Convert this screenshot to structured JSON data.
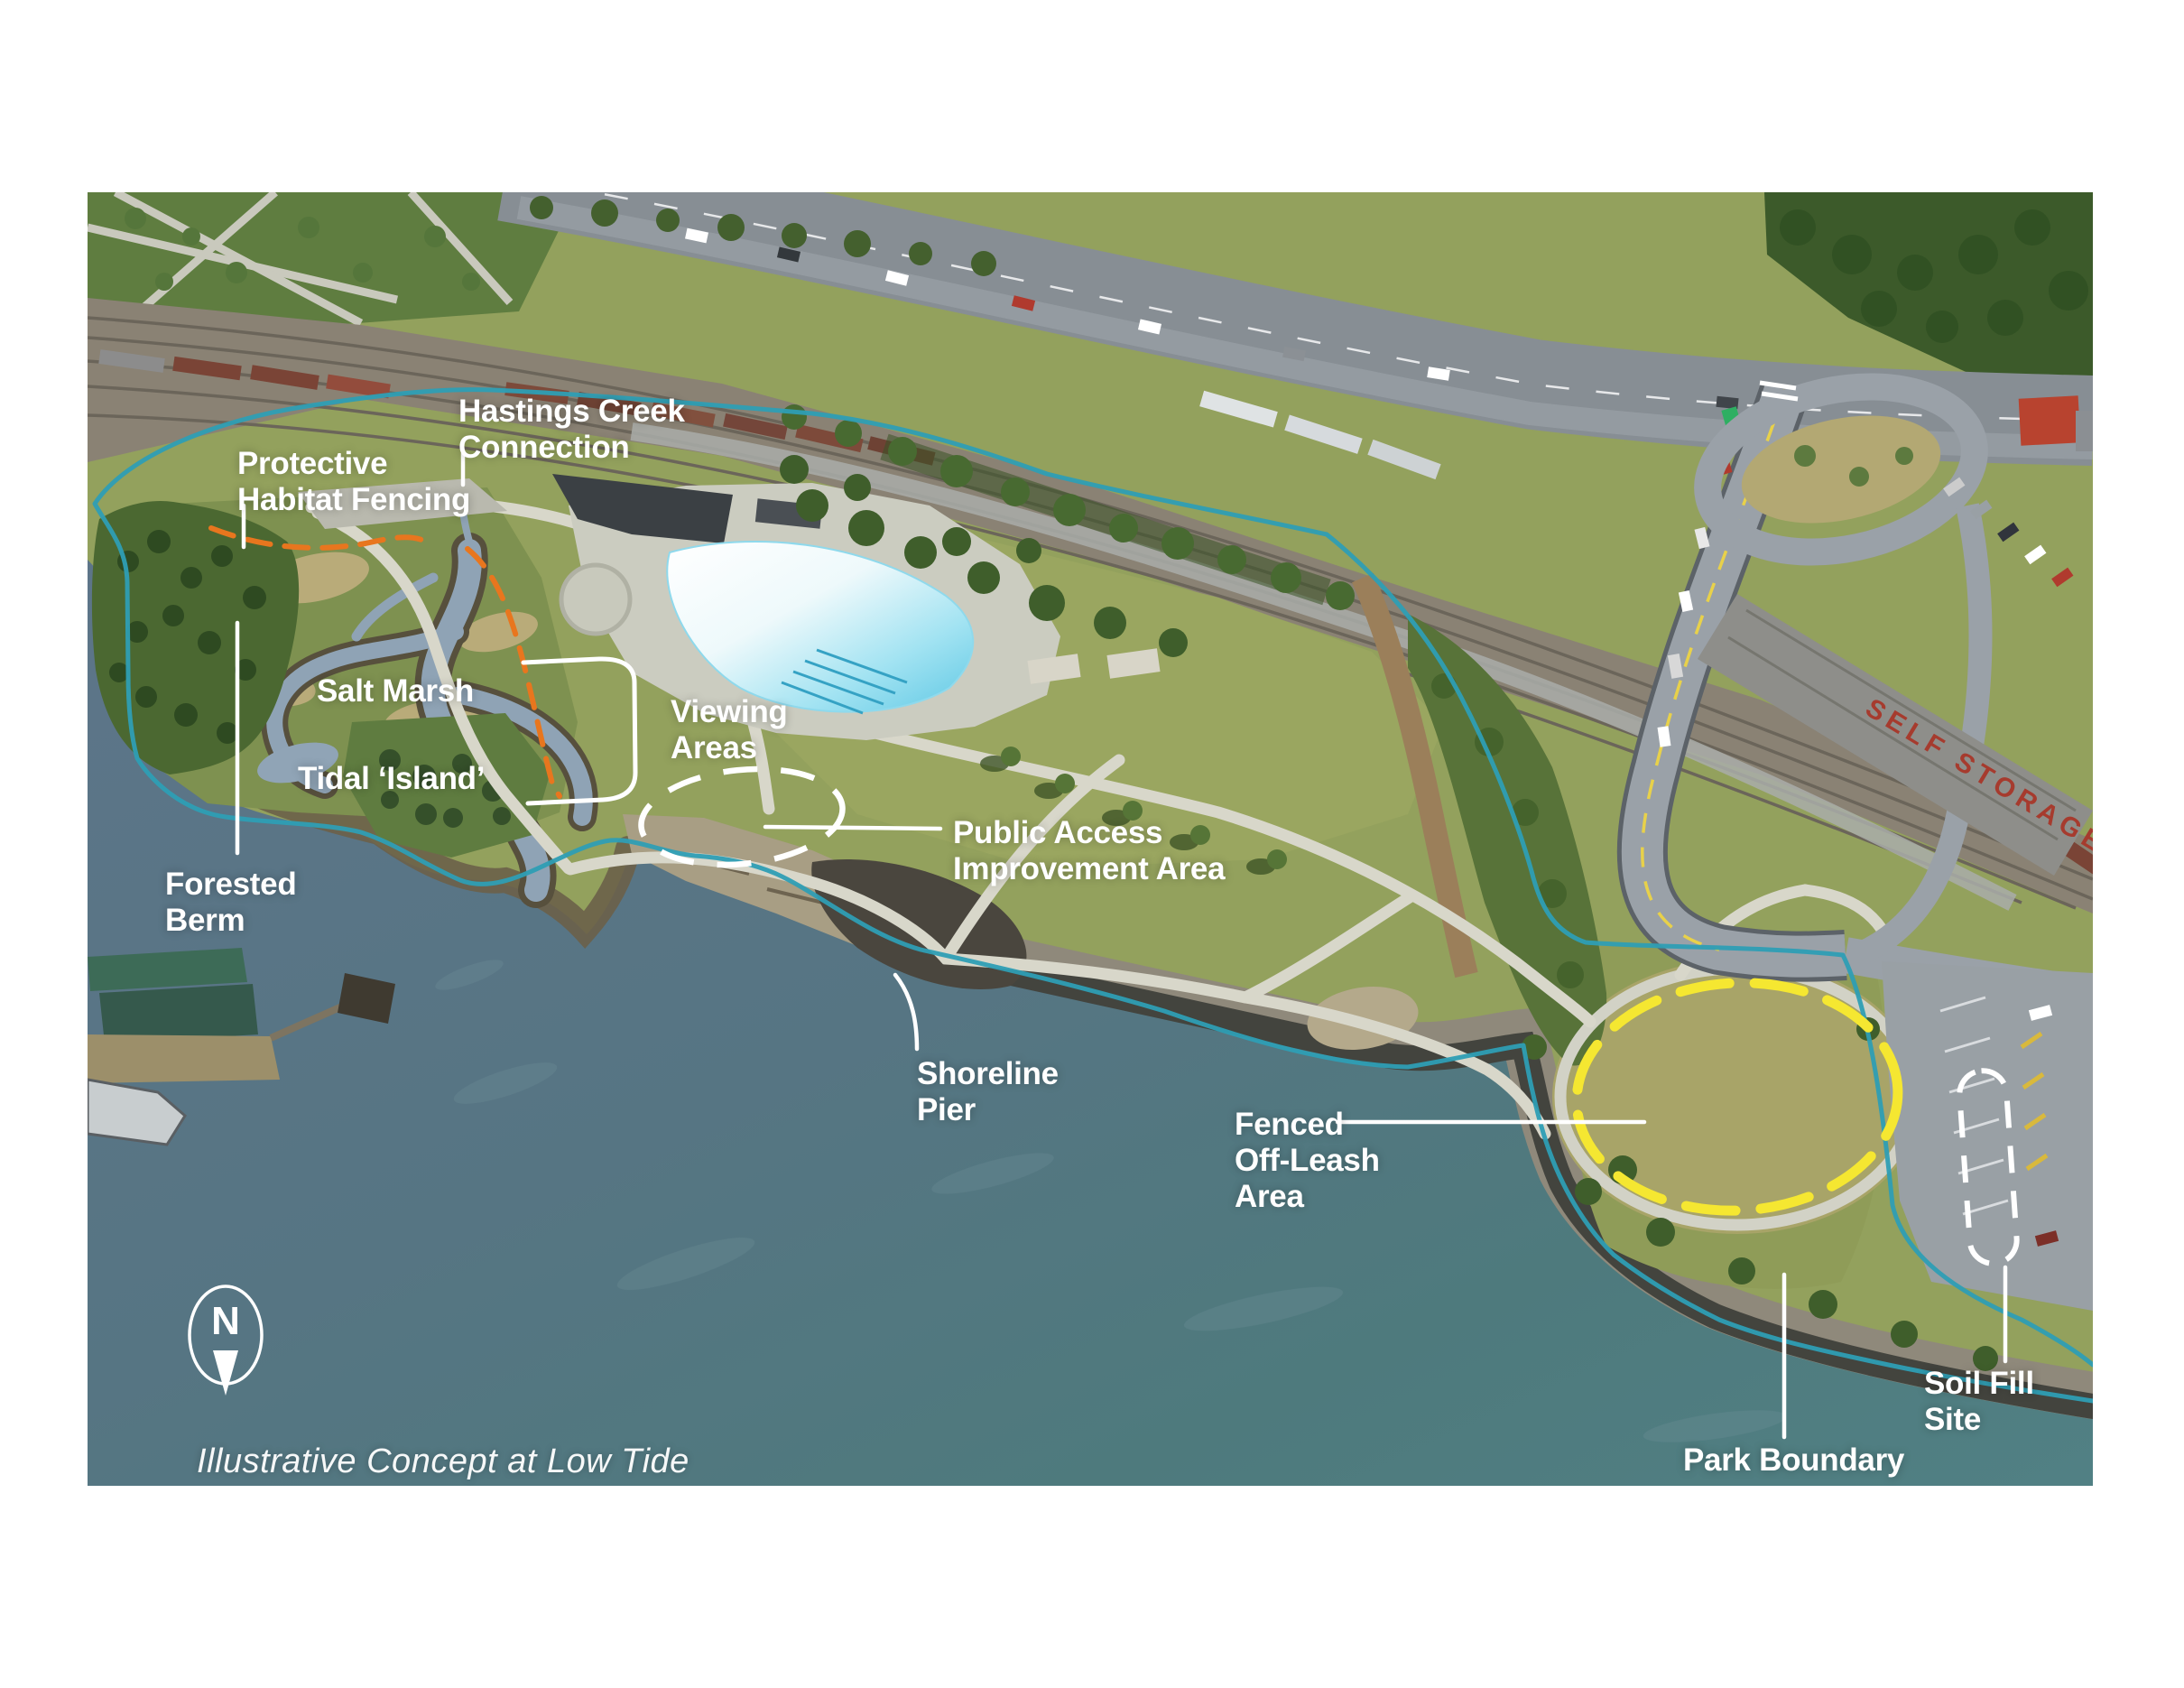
{
  "map": {
    "caption": "Illustrative Concept at Low Tide",
    "compass": {
      "letter": "N"
    }
  },
  "labels": {
    "hastings_creek_connection": "Hastings Creek\nConnection",
    "protective_habitat_fencing": "Protective\nHabitat Fencing",
    "salt_marsh": "Salt Marsh",
    "tidal_island": "Tidal ‘Island’",
    "forested_berm": "Forested\nBerm",
    "viewing_areas": "Viewing\nAreas",
    "public_access_improvement_area": "Public Access\nImprovement Area",
    "shoreline_pier": "Shoreline\nPier",
    "fenced_off_leash_area": "Fenced\nOff-Leash\nArea",
    "park_boundary": "Park Boundary",
    "soil_fill_site": "Soil Fill Site"
  },
  "buildings": {
    "self_storage_roof_text": "SELF STORAGE"
  },
  "colors": {
    "park_boundary": "#2E9EB4",
    "habitat_fencing": "#E8761E",
    "off_leash_circle": "#F5E731",
    "annotation_white": "#FFFFFF"
  }
}
